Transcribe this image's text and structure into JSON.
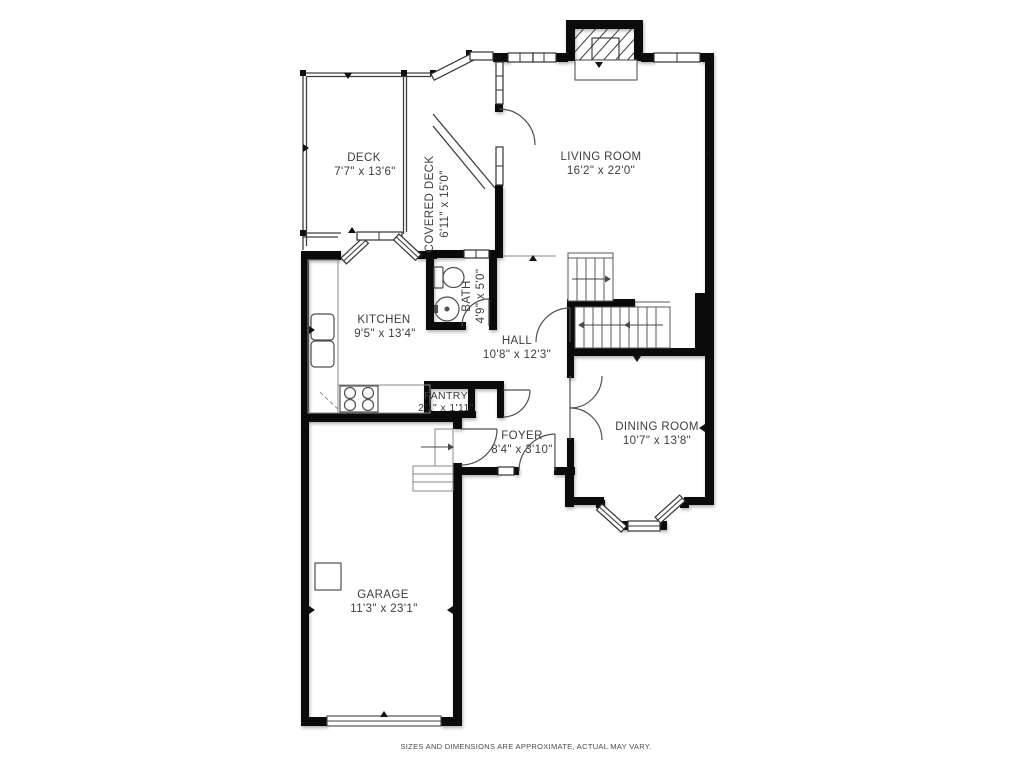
{
  "rooms": {
    "deck": {
      "name": "DECK",
      "dims": "7'7\" x 13'6\""
    },
    "covered_deck": {
      "name": "COVERED DECK",
      "dims": "6'11\" x 15'0\""
    },
    "living_room": {
      "name": "LIVING ROOM",
      "dims": "16'2\" x 22'0\""
    },
    "kitchen": {
      "name": "KITCHEN",
      "dims": "9'5\" x 13'4\""
    },
    "bath": {
      "name": "BATH",
      "dims": "4'9\" x 5'0\""
    },
    "hall": {
      "name": "HALL",
      "dims": "10'8\" x 12'3\""
    },
    "pantry": {
      "name": "PANTRY",
      "dims": "2'1\" x 1'11\""
    },
    "foyer": {
      "name": "FOYER",
      "dims": "8'4\" x 3'10\""
    },
    "dining_room": {
      "name": "DINING ROOM",
      "dims": "10'7\" x 13'8\""
    },
    "garage": {
      "name": "GARAGE",
      "dims": "11'3\" x 23'1\""
    }
  },
  "footer": {
    "disclaimer": "SIZES AND DIMENSIONS ARE APPROXIMATE, ACTUAL MAY VARY."
  },
  "colors": {
    "wall": "#0b0b0b",
    "text": "#3d3d3d",
    "line": "#4f4f4f",
    "background": "#ffffff"
  }
}
